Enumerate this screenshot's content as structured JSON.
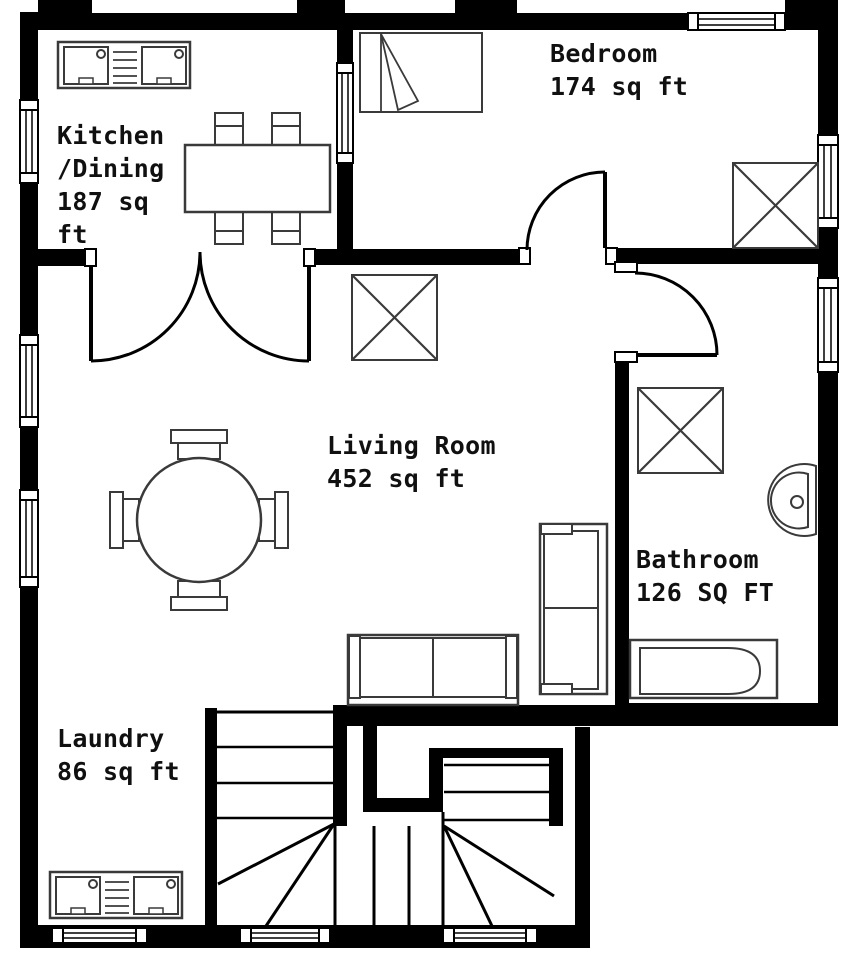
{
  "rooms": [
    {
      "id": "kitchen-dining",
      "label": "Kitchen\n/Dining\n187 sq\nft",
      "area_sqft": 187
    },
    {
      "id": "bedroom",
      "label": "Bedroom\n174 sq ft",
      "area_sqft": 174
    },
    {
      "id": "living-room",
      "label": "Living Room\n452 sq ft",
      "area_sqft": 452
    },
    {
      "id": "bathroom",
      "label": "Bathroom\n126 SQ FT",
      "area_sqft": 126
    },
    {
      "id": "laundry",
      "label": "Laundry\n86 sq ft",
      "area_sqft": 86
    }
  ],
  "colors": {
    "wall": "#000000",
    "fixture_line": "#3a3a3a",
    "background": "#ffffff",
    "text": "#101010"
  }
}
